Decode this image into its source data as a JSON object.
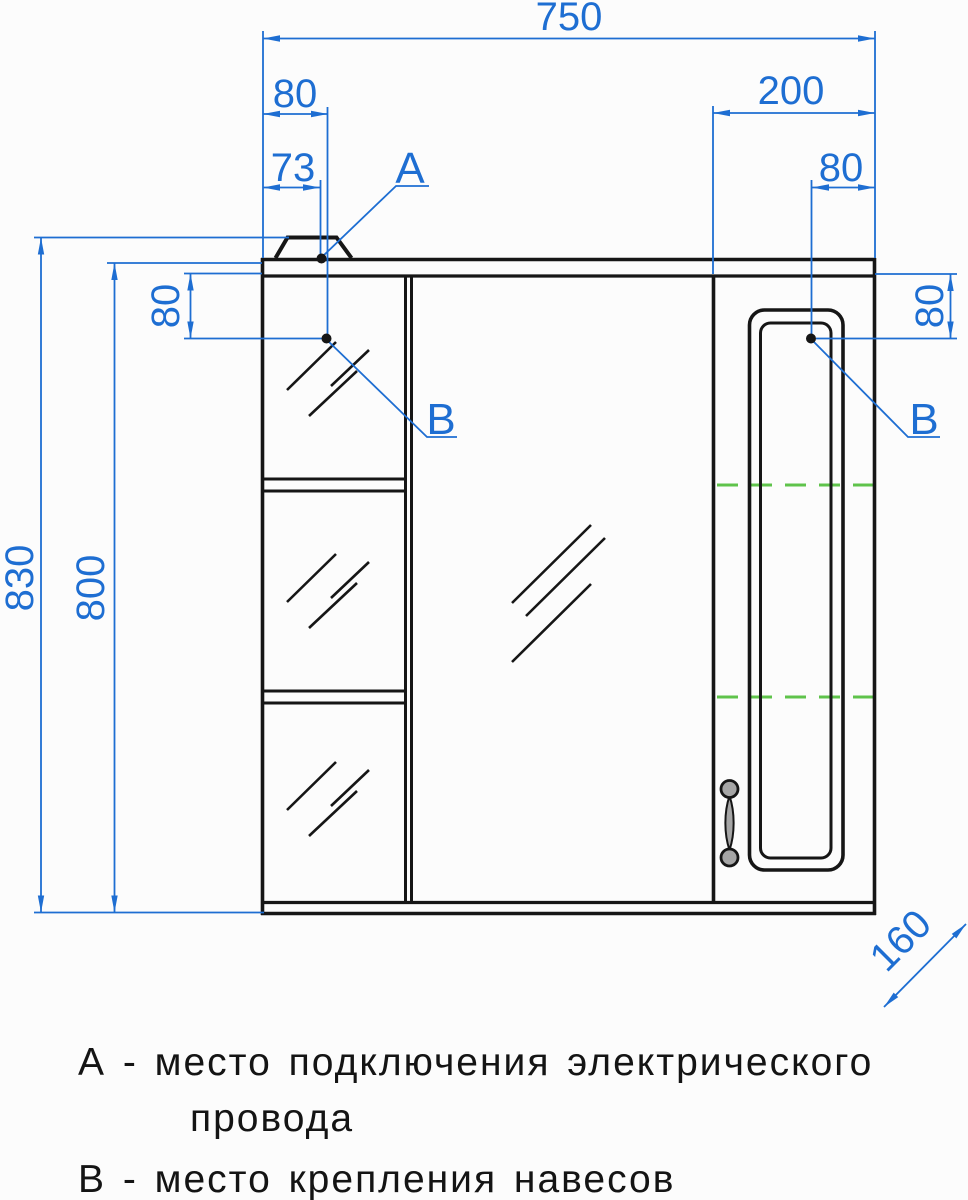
{
  "drawing": {
    "dimensions": {
      "total_width": "750",
      "top_offset_outer": "80",
      "top_offset_a": "73",
      "right_section_width": "200",
      "right_offset": "80",
      "left_side_offset": "80",
      "right_side_offset": "80",
      "overall_height": "830",
      "body_height": "800",
      "depth": "160"
    },
    "markers": {
      "a": "А",
      "b": "В"
    },
    "colors": {
      "dimension_blue": "#1e6ed2",
      "shelf_line_green": "#5fc34b",
      "outline_black": "#161616",
      "background": "#fcfcfc"
    }
  },
  "legend": {
    "note_a_line1": "А - место подключения электрического",
    "note_a_line2": "провода",
    "note_b": "В - место крепления навесов"
  }
}
